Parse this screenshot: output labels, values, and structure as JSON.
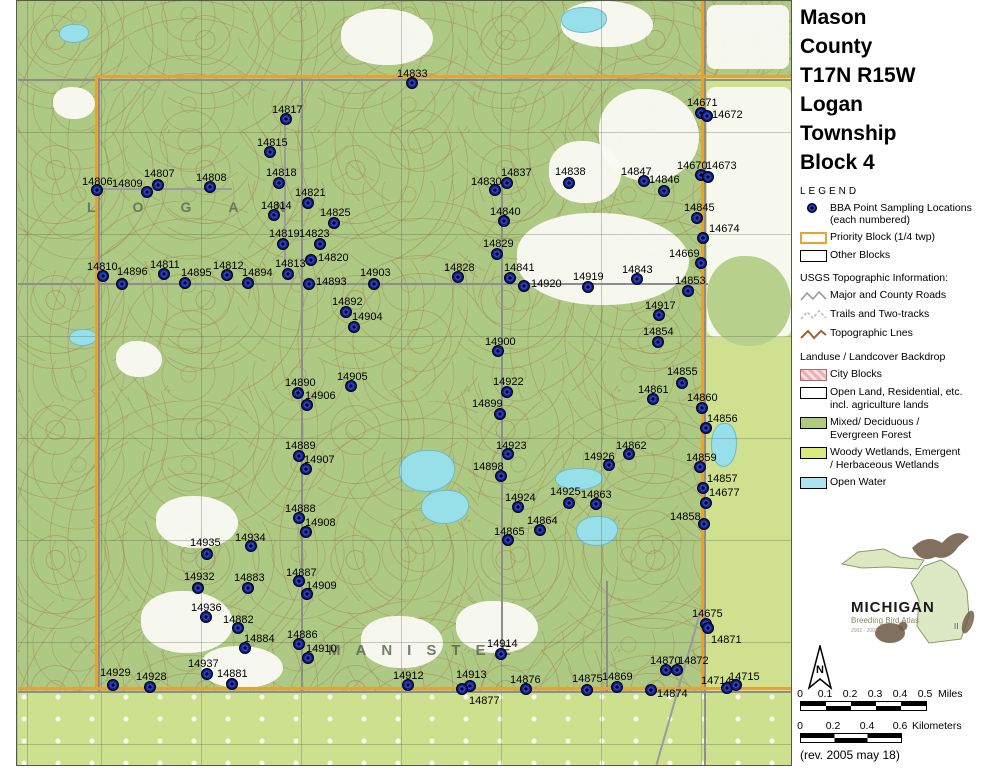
{
  "page": {
    "title_lines": [
      "Mason",
      "County",
      "T17N R15W",
      "Logan",
      "Township",
      "Block 4"
    ]
  },
  "legend": {
    "heading": "LEGEND",
    "bba_label_1": "BBA Point Sampling Locations",
    "bba_label_2": "(each numbered)",
    "priority_label": "Priority Block (1/4 twp)",
    "other_label": "Other Blocks",
    "usgs_heading": "USGS Topographic Information:",
    "usgs_items": [
      "Major and County Roads",
      "Trails and Two-tracks",
      "Topographic Lnes"
    ],
    "landuse_heading": "Landuse / Landcover Backdrop",
    "landuse_items": [
      {
        "label": "City Blocks",
        "label2": "",
        "color": "#f0c6c6"
      },
      {
        "label": "Open Land, Residential, etc.",
        "label2": "incl. agriculture lands",
        "color": "#ffffff"
      },
      {
        "label": "Mixed/ Deciduous /",
        "label2": "Evergreen Forest",
        "color": "#aecb7e"
      },
      {
        "label": "Woody Wetlands, Emergent",
        "label2": "/ Herbaceous Wetlands",
        "color": "#dcea7d"
      },
      {
        "label": "Open Water",
        "label2": "",
        "color": "#abe4ee"
      }
    ]
  },
  "logo": {
    "name": "MICHIGAN",
    "subtitle": "Breeding Bird Atlas",
    "years": "2002 - 2007",
    "numeral": "II"
  },
  "north_label": "N",
  "scales": {
    "miles": {
      "ticks": [
        "0",
        "0.1",
        "0.2",
        "0.3",
        "0.4",
        "0.5"
      ],
      "unit": "Miles",
      "px": [
        0,
        25,
        50,
        75,
        100,
        125
      ]
    },
    "km": {
      "ticks": [
        "0",
        "0.2",
        "0.4",
        "0.6"
      ],
      "unit": "Kilometers",
      "px": [
        0,
        33,
        67,
        100
      ]
    }
  },
  "rev_note": "(rev. 2005 may 18)",
  "map": {
    "township_text": "LOGAN",
    "county_text": "MANISTEE",
    "colors": {
      "accent_orange": "#e8a232",
      "dot_navy": "#0a1a86",
      "forest": "#adc983",
      "wetland": "#cfe18f",
      "water": "#97dfe9"
    },
    "points": [
      {
        "id": "14806",
        "x": 96,
        "y": 189,
        "lx": 81,
        "ly": 176
      },
      {
        "id": "14809",
        "x": 146,
        "y": 191,
        "lx": 111,
        "ly": 178
      },
      {
        "id": "14807",
        "x": 157,
        "y": 184,
        "lx": 143,
        "ly": 168
      },
      {
        "id": "14808",
        "x": 209,
        "y": 186,
        "lx": 195,
        "ly": 172
      },
      {
        "id": "14817",
        "x": 285,
        "y": 118,
        "lx": 271,
        "ly": 104
      },
      {
        "id": "14815",
        "x": 269,
        "y": 151,
        "lx": 256,
        "ly": 137
      },
      {
        "id": "14818",
        "x": 278,
        "y": 182,
        "lx": 265,
        "ly": 167
      },
      {
        "id": "14814",
        "x": 273,
        "y": 214,
        "lx": 260,
        "ly": 200
      },
      {
        "id": "14821",
        "x": 307,
        "y": 202,
        "lx": 294,
        "ly": 187
      },
      {
        "id": "14825",
        "x": 333,
        "y": 222,
        "lx": 319,
        "ly": 207
      },
      {
        "id": "14819",
        "x": 282,
        "y": 243,
        "lx": 268,
        "ly": 228
      },
      {
        "id": "14823",
        "x": 319,
        "y": 243,
        "lx": 298,
        "ly": 228
      },
      {
        "id": "14820",
        "x": 310,
        "y": 259,
        "lx": 317,
        "ly": 252
      },
      {
        "id": "14833",
        "x": 411,
        "y": 82,
        "lx": 396,
        "ly": 68
      },
      {
        "id": "14810",
        "x": 102,
        "y": 275,
        "lx": 86,
        "ly": 261
      },
      {
        "id": "14896",
        "x": 121,
        "y": 283,
        "lx": 116,
        "ly": 266
      },
      {
        "id": "14811",
        "x": 163,
        "y": 273,
        "lx": 149,
        "ly": 259
      },
      {
        "id": "14895",
        "x": 184,
        "y": 282,
        "lx": 180,
        "ly": 267
      },
      {
        "id": "14812",
        "x": 226,
        "y": 274,
        "lx": 212,
        "ly": 260
      },
      {
        "id": "14894",
        "x": 247,
        "y": 282,
        "lx": 241,
        "ly": 267
      },
      {
        "id": "14813",
        "x": 287,
        "y": 273,
        "lx": 274,
        "ly": 258
      },
      {
        "id": "14893",
        "x": 308,
        "y": 283,
        "lx": 315,
        "ly": 276
      },
      {
        "id": "14903",
        "x": 373,
        "y": 283,
        "lx": 359,
        "ly": 267
      },
      {
        "id": "14892",
        "x": 345,
        "y": 311,
        "lx": 331,
        "ly": 296
      },
      {
        "id": "14904",
        "x": 353,
        "y": 326,
        "lx": 351,
        "ly": 311
      },
      {
        "id": "14900",
        "x": 497,
        "y": 350,
        "lx": 484,
        "ly": 336
      },
      {
        "id": "14905",
        "x": 350,
        "y": 385,
        "lx": 336,
        "ly": 371
      },
      {
        "id": "14890",
        "x": 297,
        "y": 392,
        "lx": 284,
        "ly": 377
      },
      {
        "id": "14906",
        "x": 306,
        "y": 404,
        "lx": 304,
        "ly": 390
      },
      {
        "id": "14830",
        "x": 494,
        "y": 189,
        "lx": 470,
        "ly": 176
      },
      {
        "id": "14837",
        "x": 506,
        "y": 182,
        "lx": 500,
        "ly": 167
      },
      {
        "id": "14838",
        "x": 568,
        "y": 182,
        "lx": 554,
        "ly": 166
      },
      {
        "id": "14847",
        "x": 643,
        "y": 180,
        "lx": 620,
        "ly": 166
      },
      {
        "id": "14846",
        "x": 663,
        "y": 190,
        "lx": 648,
        "ly": 174
      },
      {
        "id": "14671",
        "x": 700,
        "y": 112,
        "lx": 686,
        "ly": 97
      },
      {
        "id": "14672",
        "x": 706,
        "y": 115,
        "lx": 711,
        "ly": 109
      },
      {
        "id": "14670",
        "x": 700,
        "y": 174,
        "lx": 676,
        "ly": 160
      },
      {
        "id": "14673",
        "x": 707,
        "y": 176,
        "lx": 705,
        "ly": 160
      },
      {
        "id": "14845",
        "x": 696,
        "y": 217,
        "lx": 683,
        "ly": 202
      },
      {
        "id": "14674",
        "x": 702,
        "y": 237,
        "lx": 708,
        "ly": 223
      },
      {
        "id": "14669",
        "x": 700,
        "y": 262,
        "lx": 668,
        "ly": 248
      },
      {
        "id": "14840",
        "x": 503,
        "y": 220,
        "lx": 489,
        "ly": 206
      },
      {
        "id": "14829",
        "x": 496,
        "y": 253,
        "lx": 482,
        "ly": 238
      },
      {
        "id": "14828",
        "x": 457,
        "y": 276,
        "lx": 443,
        "ly": 262
      },
      {
        "id": "14841",
        "x": 509,
        "y": 277,
        "lx": 503,
        "ly": 262
      },
      {
        "id": "14920",
        "x": 523,
        "y": 285,
        "lx": 530,
        "ly": 278
      },
      {
        "id": "14919",
        "x": 587,
        "y": 286,
        "lx": 572,
        "ly": 271
      },
      {
        "id": "14843",
        "x": 636,
        "y": 278,
        "lx": 621,
        "ly": 264
      },
      {
        "id": "14853",
        "x": 687,
        "y": 290,
        "lx": 674,
        "ly": 275
      },
      {
        "id": "14917",
        "x": 658,
        "y": 314,
        "lx": 644,
        "ly": 300
      },
      {
        "id": "14854",
        "x": 657,
        "y": 341,
        "lx": 642,
        "ly": 326
      },
      {
        "id": "14855",
        "x": 681,
        "y": 382,
        "lx": 666,
        "ly": 366
      },
      {
        "id": "14861",
        "x": 652,
        "y": 398,
        "lx": 637,
        "ly": 384
      },
      {
        "id": "14860",
        "x": 701,
        "y": 407,
        "lx": 686,
        "ly": 392
      },
      {
        "id": "14856",
        "x": 705,
        "y": 427,
        "lx": 706,
        "ly": 413
      },
      {
        "id": "14862",
        "x": 628,
        "y": 453,
        "lx": 615,
        "ly": 440
      },
      {
        "id": "14926",
        "x": 608,
        "y": 464,
        "lx": 583,
        "ly": 451
      },
      {
        "id": "14859",
        "x": 699,
        "y": 466,
        "lx": 685,
        "ly": 452
      },
      {
        "id": "14857",
        "x": 702,
        "y": 487,
        "lx": 706,
        "ly": 473
      },
      {
        "id": "14677",
        "x": 705,
        "y": 502,
        "lx": 708,
        "ly": 487
      },
      {
        "id": "14858",
        "x": 703,
        "y": 523,
        "lx": 669,
        "ly": 511
      },
      {
        "id": "14922",
        "x": 506,
        "y": 391,
        "lx": 492,
        "ly": 376
      },
      {
        "id": "14899",
        "x": 499,
        "y": 413,
        "lx": 471,
        "ly": 398
      },
      {
        "id": "14923",
        "x": 507,
        "y": 453,
        "lx": 495,
        "ly": 440
      },
      {
        "id": "14898",
        "x": 500,
        "y": 475,
        "lx": 472,
        "ly": 461
      },
      {
        "id": "14924",
        "x": 517,
        "y": 506,
        "lx": 504,
        "ly": 492
      },
      {
        "id": "14925",
        "x": 568,
        "y": 502,
        "lx": 549,
        "ly": 486
      },
      {
        "id": "14863",
        "x": 595,
        "y": 503,
        "lx": 580,
        "ly": 489
      },
      {
        "id": "14864",
        "x": 539,
        "y": 529,
        "lx": 526,
        "ly": 515
      },
      {
        "id": "14865",
        "x": 507,
        "y": 539,
        "lx": 493,
        "ly": 526
      },
      {
        "id": "14889",
        "x": 298,
        "y": 455,
        "lx": 284,
        "ly": 440
      },
      {
        "id": "14907",
        "x": 305,
        "y": 468,
        "lx": 303,
        "ly": 454
      },
      {
        "id": "14888",
        "x": 298,
        "y": 517,
        "lx": 284,
        "ly": 503
      },
      {
        "id": "14908",
        "x": 305,
        "y": 531,
        "lx": 304,
        "ly": 517
      },
      {
        "id": "14935",
        "x": 206,
        "y": 553,
        "lx": 189,
        "ly": 537
      },
      {
        "id": "14934",
        "x": 250,
        "y": 545,
        "lx": 234,
        "ly": 532
      },
      {
        "id": "14932",
        "x": 197,
        "y": 587,
        "lx": 183,
        "ly": 571
      },
      {
        "id": "14883",
        "x": 247,
        "y": 587,
        "lx": 233,
        "ly": 572
      },
      {
        "id": "14887",
        "x": 298,
        "y": 580,
        "lx": 285,
        "ly": 567
      },
      {
        "id": "14909",
        "x": 306,
        "y": 593,
        "lx": 305,
        "ly": 580
      },
      {
        "id": "14936",
        "x": 205,
        "y": 616,
        "lx": 190,
        "ly": 602
      },
      {
        "id": "14882",
        "x": 237,
        "y": 627,
        "lx": 222,
        "ly": 614
      },
      {
        "id": "14884",
        "x": 244,
        "y": 647,
        "lx": 243,
        "ly": 633
      },
      {
        "id": "14886",
        "x": 298,
        "y": 643,
        "lx": 286,
        "ly": 629
      },
      {
        "id": "14910",
        "x": 307,
        "y": 657,
        "lx": 305,
        "ly": 643
      },
      {
        "id": "14937",
        "x": 206,
        "y": 673,
        "lx": 187,
        "ly": 658
      },
      {
        "id": "14881",
        "x": 231,
        "y": 683,
        "lx": 216,
        "ly": 668
      },
      {
        "id": "14929",
        "x": 112,
        "y": 684,
        "lx": 99,
        "ly": 667
      },
      {
        "id": "14928",
        "x": 149,
        "y": 686,
        "lx": 135,
        "ly": 671
      },
      {
        "id": "14912",
        "x": 407,
        "y": 684,
        "lx": 392,
        "ly": 670
      },
      {
        "id": "14914",
        "x": 500,
        "y": 653,
        "lx": 486,
        "ly": 638
      },
      {
        "id": "14913",
        "x": 469,
        "y": 685,
        "lx": 455,
        "ly": 669
      },
      {
        "id": "14877",
        "x": 461,
        "y": 688,
        "lx": 468,
        "ly": 695
      },
      {
        "id": "14876",
        "x": 525,
        "y": 688,
        "lx": 509,
        "ly": 674
      },
      {
        "id": "14875",
        "x": 586,
        "y": 689,
        "lx": 571,
        "ly": 673
      },
      {
        "id": "14869",
        "x": 616,
        "y": 686,
        "lx": 601,
        "ly": 671
      },
      {
        "id": "14874",
        "x": 650,
        "y": 689,
        "lx": 656,
        "ly": 688
      },
      {
        "id": "14870",
        "x": 665,
        "y": 669,
        "lx": 649,
        "ly": 655
      },
      {
        "id": "14872",
        "x": 676,
        "y": 669,
        "lx": 677,
        "ly": 655
      },
      {
        "id": "14675",
        "x": 705,
        "y": 623,
        "lx": 691,
        "ly": 608
      },
      {
        "id": "14871",
        "x": 707,
        "y": 627,
        "lx": 710,
        "ly": 634
      },
      {
        "id": "14714",
        "x": 726,
        "y": 687,
        "lx": 700,
        "ly": 675
      },
      {
        "id": "14715",
        "x": 735,
        "y": 684,
        "lx": 728,
        "ly": 671
      }
    ]
  }
}
